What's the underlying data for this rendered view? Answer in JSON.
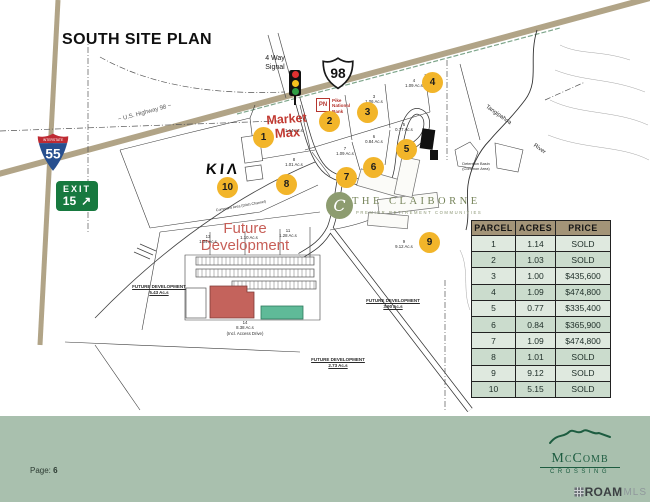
{
  "page": {
    "title": "SOUTH SITE PLAN",
    "page_label": "Page:",
    "page_number": "6"
  },
  "signs": {
    "interstate_label": "INTERSTATE",
    "interstate_number": "55",
    "exit_word": "EXIT",
    "exit_number": "15",
    "exit_arrow": "↗",
    "route_shield": "98"
  },
  "logos": {
    "market_max_line1": "Market",
    "market_max_line2": "Max",
    "pike_monogram": "PN",
    "pike_name": "Pike\nNational\nBank",
    "kia": "KIΛ",
    "claiborne_initial": "C",
    "claiborne_name": "THE CLAIBORNE",
    "claiborne_tagline": "PREMIER RETIREMENT COMMUNITIES",
    "mccomb_name": "McComb",
    "mccomb_sub": "CROSSING",
    "roam_name": "ROAM",
    "roam_suffix": "MLS"
  },
  "map": {
    "future_dev_main": "Future\nDevelopment",
    "markers": [
      "1",
      "2",
      "3",
      "4",
      "5",
      "6",
      "7",
      "8",
      "9",
      "10"
    ],
    "labels": [
      {
        "id": "four-way-signal",
        "text": "4 Way\nSignal"
      },
      {
        "id": "us-highway-98",
        "text": "~ U.S. Highway 98 ~"
      },
      {
        "id": "parcel-1",
        "text": "1.14 Ac.s"
      },
      {
        "id": "parcel-8",
        "text": "8\n1.01 Ac.s"
      },
      {
        "id": "parcel-7",
        "text": "7\n1.09 Ac.s"
      },
      {
        "id": "parcel-6",
        "text": "6\n0.84 Ac.s"
      },
      {
        "id": "parcel-5",
        "text": "5\n0.77 Ac.s"
      },
      {
        "id": "parcel-3",
        "text": "3\n1.06 Ac.s"
      },
      {
        "id": "parcel-4",
        "text": "4\n1.09 Ac.s"
      },
      {
        "id": "parcel-9",
        "text": "9\n9.12 Ac.s"
      },
      {
        "id": "parcel-11",
        "text": "11\n1.28 Ac.s"
      },
      {
        "id": "parcel-12",
        "text": "1.10 Ac.s"
      },
      {
        "id": "parcel-13",
        "text": "13\n1.04 Ac.s"
      },
      {
        "id": "parcel-14",
        "text": "14\n8.38 Ac.s\n(Incl. Access Drive)"
      },
      {
        "id": "future-dev-543",
        "text": "FUTURE DEVELOPMENT\n5.43 Ac.s"
      },
      {
        "id": "future-dev-390",
        "text": "FUTURE DEVELOPMENT\n3.90 Ac.s"
      },
      {
        "id": "future-dev-273",
        "text": "FUTURE DEVELOPMENT\n2.73 Ac.s"
      },
      {
        "id": "detention-basin",
        "text": "Detention Basin\n(Common Area)"
      },
      {
        "id": "river-name",
        "text": "Tangipahoa"
      },
      {
        "id": "river-word",
        "text": "River"
      },
      {
        "id": "commons-area",
        "text": "Commons Area (Ditch Channel)"
      }
    ]
  },
  "table": {
    "headers": [
      "PARCEL",
      "ACRES",
      "PRICE"
    ],
    "rows": [
      [
        "1",
        "1.14",
        "SOLD"
      ],
      [
        "2",
        "1.03",
        "SOLD"
      ],
      [
        "3",
        "1.00",
        "$435,600"
      ],
      [
        "4",
        "1.09",
        "$474,800"
      ],
      [
        "5",
        "0.77",
        "$335,400"
      ],
      [
        "6",
        "0.84",
        "$365,900"
      ],
      [
        "7",
        "1.09",
        "$474,800"
      ],
      [
        "8",
        "1.01",
        "SOLD"
      ],
      [
        "9",
        "9.12",
        "SOLD"
      ],
      [
        "10",
        "5.15",
        "SOLD"
      ]
    ]
  },
  "colors": {
    "footer_sage": "#a9c0ae",
    "table_header_tan": "#a39478",
    "row_light": "#dfe9df",
    "row_dark": "#cbdccd",
    "marker_yellow": "#f2b52a",
    "road_tan": "#b1a487",
    "brand_red": "#c13a32",
    "exit_green": "#17793f",
    "interstate_blue": "#274f8f",
    "interstate_red": "#bf2b33",
    "claiborne_sage": "#8d9c70",
    "mccomb_green": "#1d5c40",
    "building_red": "#c4635c",
    "building_teal": "#5fba98"
  }
}
